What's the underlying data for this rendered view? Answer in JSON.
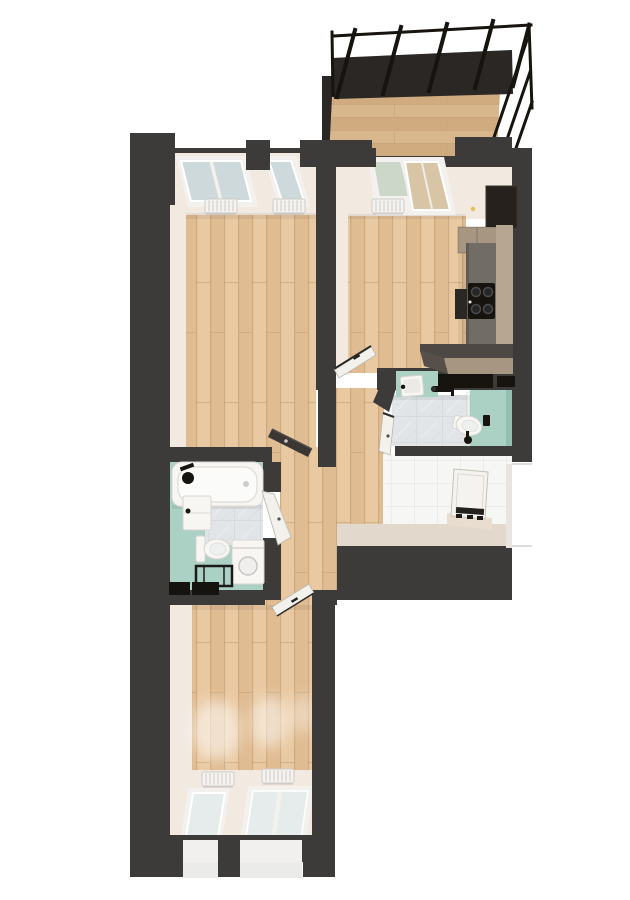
{
  "meta": {
    "type": "3d-floor-plan-render",
    "view": "top-down",
    "background": "#ffffff"
  },
  "palette": {
    "wall": "#3d3b39",
    "wallDark": "#2a2724",
    "wood1": "#e9c9a2",
    "wood2": "#e0bc92",
    "woodLine": "#c8a478",
    "deck1": "#d9b78c",
    "deck2": "#cfab7f",
    "cream": "#f2e9e1",
    "creamDark": "#e3d8cc",
    "teal": "#abd0c4",
    "tealDark": "#93bfb1",
    "marbleBase": "#e2e5e7",
    "marbleLine": "#ccd1d4",
    "tileBase": "#f6f6f4",
    "tileLine": "#e3e3e0",
    "glass": "#cdd9db",
    "glassGreen": "#ccd6c9",
    "glassWarm": "#d8c5a5",
    "glassLight": "#e6ebec",
    "fixtureWhite": "#f7f6f3",
    "counter": "#716c66",
    "cabinet": "#b7a692",
    "cabinetDark": "#a69682",
    "black": "#17140f",
    "leafDark": "#3b3734"
  },
  "rooms": [
    {
      "id": "balcony",
      "name": "Balcony with pergola",
      "floor": "wood-deck",
      "features": [
        "pergola-beams",
        "dark-shade-band",
        "corner-posts"
      ]
    },
    {
      "id": "living-room",
      "name": "Living room",
      "floor": "wood-planks",
      "features": [
        "double-window",
        "single-window",
        "radiator",
        "radiator",
        "dark-door"
      ]
    },
    {
      "id": "kitchen",
      "name": "Kitchen / living area",
      "floor": "wood-planks",
      "features": [
        "balcony-glass-door",
        "window",
        "radiator",
        "tall-dark-cabinet",
        "wall-cabinets",
        "worktop",
        "cooktop",
        "oven",
        "l-shaped-counter",
        "white-door",
        "switch"
      ]
    },
    {
      "id": "shower-wc",
      "name": "Shower WC",
      "floor": "marble-tile-and-teal",
      "features": [
        "wash-basin",
        "shower-set",
        "wall-hung-toilet",
        "flush-plate",
        "toilet-brush",
        "black-wall-shelves",
        "glass-screen",
        "white-door"
      ]
    },
    {
      "id": "entry",
      "name": "Entry hall",
      "floor": "white-tile",
      "features": [
        "entrance-door",
        "door-step",
        "door-hinges"
      ]
    },
    {
      "id": "bathroom",
      "name": "Bathroom",
      "floor": "marble-tile-and-teal",
      "features": [
        "bathtub",
        "shower-mixer",
        "wash-basin-cabinet",
        "toilet",
        "washing-machine",
        "towel-bench",
        "bath-mat",
        "bath-mat",
        "white-door"
      ]
    },
    {
      "id": "hallway",
      "name": "Hallway",
      "floor": "wood-planks",
      "features": []
    },
    {
      "id": "bedroom",
      "name": "Bedroom",
      "floor": "wood-planks",
      "features": [
        "single-window",
        "double-window",
        "radiator",
        "radiator",
        "sunlight-patches",
        "white-door",
        "outer-sills"
      ]
    }
  ]
}
